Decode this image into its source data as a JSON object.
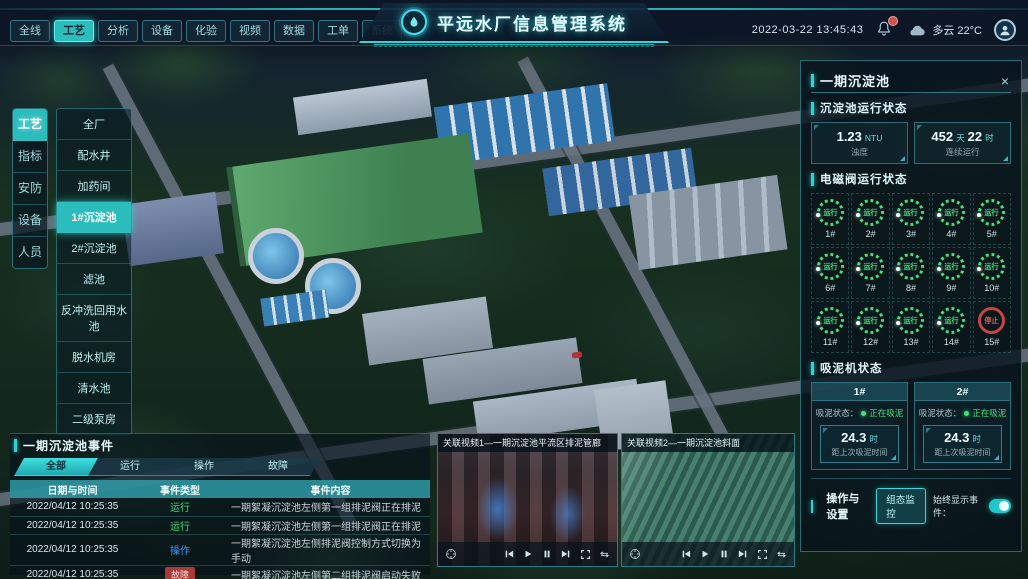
{
  "header": {
    "nav_tabs": [
      "全线",
      "工艺",
      "分析",
      "设备",
      "化验",
      "视频",
      "数据",
      "工单",
      "系统"
    ],
    "active_nav_tab": "工艺",
    "title": "平远水厂信息管理系统",
    "datetime": "2022-03-22 13:45:43",
    "weather_text": "多云 22°C"
  },
  "sidebar": {
    "tabs": [
      "工艺",
      "指标",
      "安防",
      "设备",
      "人员"
    ],
    "active_tab": "工艺",
    "menu_items": [
      "全厂",
      "配水井",
      "加药间",
      "1#沉淀池",
      "2#沉淀池",
      "滤池",
      "反冲洗回用水池",
      "脱水机房",
      "清水池",
      "二级泵房"
    ],
    "active_menu_item": "1#沉淀池"
  },
  "detail_panel": {
    "title": "一期沉淀池",
    "close_glyph": "×",
    "pool_status": {
      "title": "沉淀池运行状态",
      "stats": [
        {
          "value": "1.23",
          "unit": "NTU",
          "label": "浊度"
        },
        {
          "value": "452",
          "unit": "天",
          "value2": "22",
          "unit2": "时",
          "label": "连续运行"
        }
      ]
    },
    "valve_section": {
      "title": "电磁阀运行状态",
      "valves": [
        {
          "id": "1#",
          "status": "运行"
        },
        {
          "id": "2#",
          "status": "运行"
        },
        {
          "id": "3#",
          "status": "运行"
        },
        {
          "id": "4#",
          "status": "运行"
        },
        {
          "id": "5#",
          "status": "运行"
        },
        {
          "id": "6#",
          "status": "运行"
        },
        {
          "id": "7#",
          "status": "运行"
        },
        {
          "id": "8#",
          "status": "运行"
        },
        {
          "id": "9#",
          "status": "运行"
        },
        {
          "id": "10#",
          "status": "运行"
        },
        {
          "id": "11#",
          "status": "运行"
        },
        {
          "id": "12#",
          "status": "运行"
        },
        {
          "id": "13#",
          "status": "运行"
        },
        {
          "id": "14#",
          "status": "运行"
        },
        {
          "id": "15#",
          "status": "停止"
        }
      ]
    },
    "mud_section": {
      "title": "吸泥机状态",
      "machines": [
        {
          "name": "1#",
          "status_label": "吸泥状态：",
          "status": "正在吸泥",
          "value": "24.3",
          "unit": "时",
          "caption": "距上次吸泥时间"
        },
        {
          "name": "2#",
          "status_label": "吸泥状态：",
          "status": "正在吸泥",
          "value": "24.3",
          "unit": "时",
          "caption": "距上次吸泥时间"
        }
      ]
    },
    "settings": {
      "title": "操作与设置",
      "monitor_button": "组态监控",
      "toggle_label": "始终显示事件：",
      "toggle_on": true
    }
  },
  "events_panel": {
    "title": "一期沉淀池事件",
    "tabs": [
      "全部",
      "运行",
      "操作",
      "故障"
    ],
    "active_tab": "全部",
    "columns": [
      "日期与时间",
      "事件类型",
      "事件内容"
    ],
    "rows": [
      {
        "time": "2022/04/12 10:25:35",
        "type": "运行",
        "content": "一期絮凝沉淀池左侧第一组排泥阀正在排泥"
      },
      {
        "time": "2022/04/12 10:25:35",
        "type": "运行",
        "content": "一期絮凝沉淀池左侧第一组排泥阀正在排泥"
      },
      {
        "time": "2022/04/12 10:25:35",
        "type": "操作",
        "content": "一期絮凝沉淀池左侧排泥阀控制方式切换为手动"
      },
      {
        "time": "2022/04/12 10:25:35",
        "type": "故障",
        "content": "一期絮凝沉淀池左侧第二组排泥阀启动失败"
      }
    ]
  },
  "videos": [
    {
      "title": "关联视频1—一期沉淀池平流区排泥管廊"
    },
    {
      "title": "关联视频2—一期沉淀池斜面"
    }
  ],
  "colors": {
    "accent": "#2fd3d3",
    "status_run": "#35d97c",
    "status_operate": "#3f9bff",
    "status_fault": "#c64444",
    "valve_run_ring": "#49e07a",
    "valve_stop_ring": "#c64444"
  }
}
